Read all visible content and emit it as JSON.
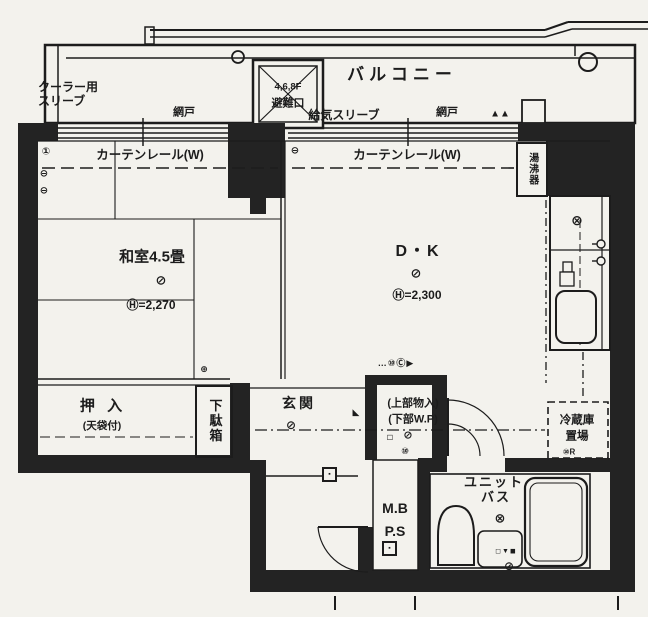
{
  "colors": {
    "paper": "#f3f2ed",
    "ink": "#1c1c1c",
    "wall": "#232323"
  },
  "balcony": {
    "label": "バルコニー",
    "cooler_line1": "クーラー用",
    "cooler_line2": "スリーブ",
    "screen_left": "網戸",
    "air_supply": "給気スリーブ",
    "screen_right": "網戸",
    "triangles": "▲▲",
    "hatch_floors": "4,6,8F",
    "hatch_label": "避難口"
  },
  "curtain": {
    "left": "カーテンレール(W)",
    "right": "カーテンレール(W)"
  },
  "washitsu": {
    "name": "和室4.5畳",
    "light": "⊘",
    "height": "Ⓗ=2,270",
    "corner_mark": "⊕"
  },
  "dk": {
    "name": "D・K",
    "light": "⊘",
    "height": "Ⓗ=2,300",
    "outlet": "⊖"
  },
  "oshiire": {
    "name": "押 入",
    "sub": "(天袋付)"
  },
  "getabako": {
    "name": "下駄箱"
  },
  "genkan": {
    "name": "玄関",
    "light": "⊘",
    "door_mark": "◣",
    "bell_box": "▪"
  },
  "closet": {
    "upper": "(上部物入)",
    "lower": "(下部W.P)",
    "mark": "◻",
    "light": "⊘",
    "circle_mark": "⑩",
    "symbol_row": "…⑩Ⓒ▶"
  },
  "mb_ps": {
    "line1": "M.B",
    "line2": "P.S",
    "meter_box": "▪"
  },
  "bath": {
    "name1": "ユニット",
    "name2": "バス",
    "vent": "⊗",
    "basin_marks": "◻▼◼",
    "drain": "⊘"
  },
  "fridge": {
    "line1": "冷蔵庫",
    "line2": "置場",
    "mark": "⑩R"
  },
  "water_heater": {
    "name": "湯沸器"
  },
  "kitchen": {
    "stove": "⊗"
  },
  "wall_symbols": {
    "s1": "①",
    "s2": "⊖",
    "s3": "⊖"
  }
}
